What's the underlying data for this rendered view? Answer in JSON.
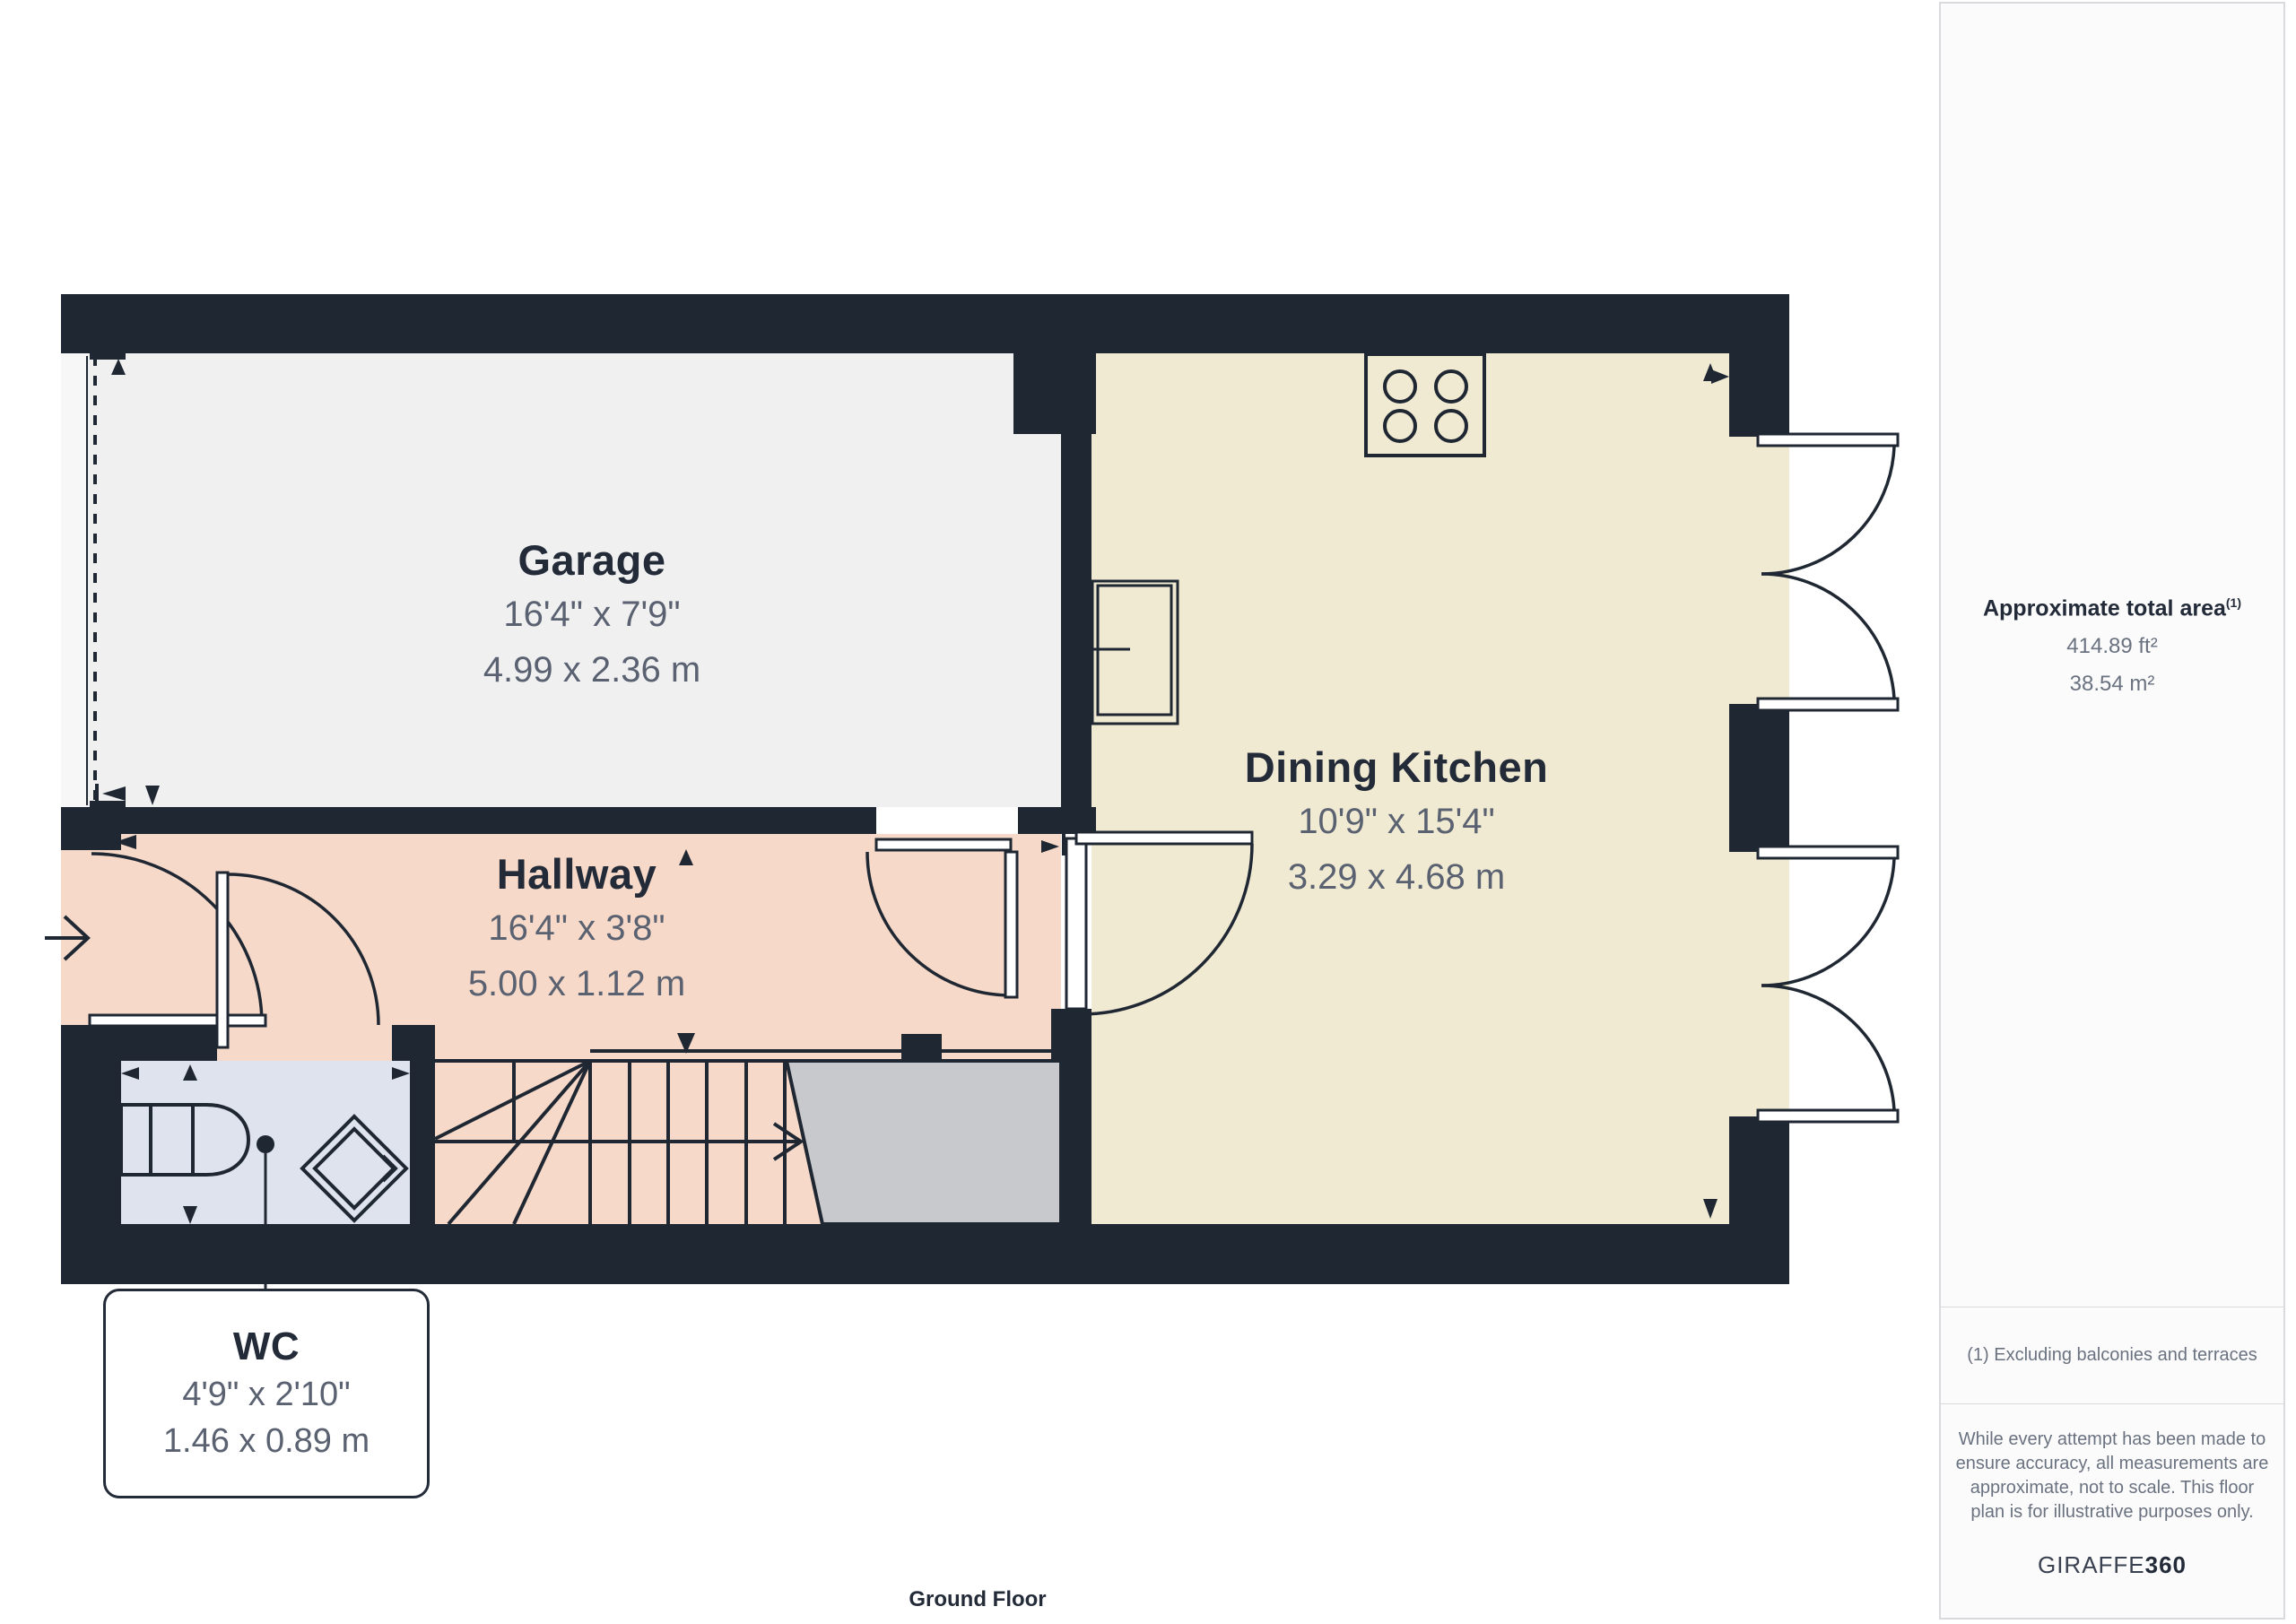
{
  "floor_label": "Ground Floor",
  "rooms": {
    "garage": {
      "name": "Garage",
      "dim_imperial": "16'4\" x 7'9\"",
      "dim_metric": "4.99 x 2.36 m"
    },
    "dining_kitchen": {
      "name": "Dining Kitchen",
      "dim_imperial": "10'9\" x 15'4\"",
      "dim_metric": "3.29 x 4.68 m"
    },
    "hallway": {
      "name": "Hallway",
      "dim_imperial": "16'4\" x 3'8\"",
      "dim_metric": "5.00 x 1.12 m"
    },
    "wc": {
      "name": "WC",
      "dim_imperial": "4'9\" x 2'10\"",
      "dim_metric": "1.46 x 0.89 m"
    }
  },
  "sidebar": {
    "total_area_label": "Approximate total area",
    "total_area_sup": "(1)",
    "area_ft": "414.89 ft²",
    "area_m": "38.54 m²",
    "footnote": "(1) Excluding balconies and terraces",
    "disclaimer_lines": [
      "While every attempt has been made to",
      "ensure accuracy, all measurements are",
      "approximate, not to scale. This floor",
      "plan is for illustrative purposes only."
    ],
    "brand": "GIRAFFE",
    "brand_suffix": "360"
  },
  "colors": {
    "wall": "#1f2733",
    "garage": "#f0f0f1",
    "garagedoor": "#f7f7f8",
    "hallway": "#f6d9c8",
    "kitchen": "#f1ead3",
    "wcroom": "#dfe3ee",
    "landing": "#c8c9cc",
    "title": "#232b39",
    "dim": "#5a6170",
    "sidetext": "#6a7280",
    "border": "#d8dade"
  }
}
